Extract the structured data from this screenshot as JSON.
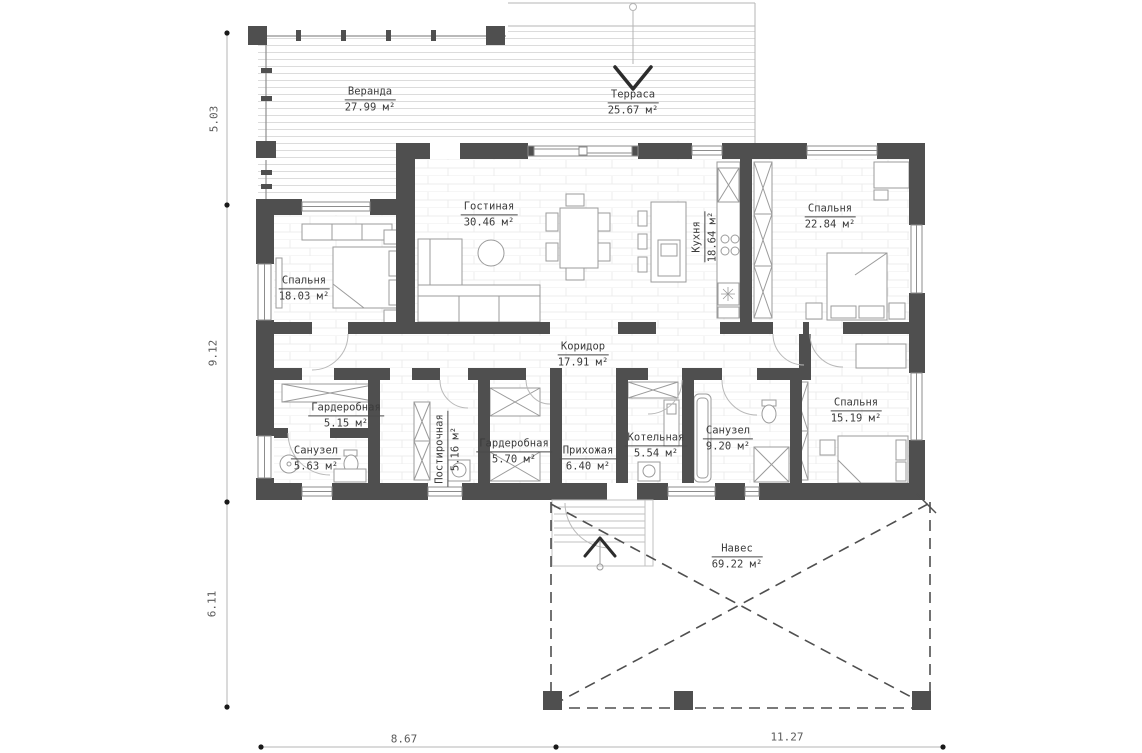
{
  "plan": {
    "rooms": {
      "veranda": {
        "name": "Веранда",
        "area": "27.99 м²"
      },
      "terrace": {
        "name": "Терраса",
        "area": "25.67 м²"
      },
      "living": {
        "name": "Гостиная",
        "area": "30.46 м²"
      },
      "kitchen": {
        "name": "Кухня",
        "area": "18.64 м²"
      },
      "bedroom1": {
        "name": "Спальня",
        "area": "18.03 м²"
      },
      "bedroom2": {
        "name": "Спальня",
        "area": "22.84 м²"
      },
      "bedroom3": {
        "name": "Спальня",
        "area": "15.19 м²"
      },
      "corridor": {
        "name": "Коридор",
        "area": "17.91 м²"
      },
      "wardrobe1": {
        "name": "Гардеробная",
        "area": "5.15 м²"
      },
      "wardrobe2": {
        "name": "Гардеробная",
        "area": "5.70 м²"
      },
      "laundry": {
        "name": "Постирочная",
        "area": "5.16 м²"
      },
      "bath1": {
        "name": "Санузел",
        "area": "5.63 м²"
      },
      "bath2": {
        "name": "Санузел",
        "area": "9.20 м²"
      },
      "boiler": {
        "name": "Котельная",
        "area": "5.54 м²"
      },
      "hallway": {
        "name": "Прихожая",
        "area": "6.40 м²"
      },
      "canopy": {
        "name": "Навес",
        "area": "69.22 м²"
      }
    },
    "dimensions": {
      "left": [
        "5.03",
        "9.12",
        "6.11"
      ],
      "bottom": [
        "8.67",
        "11.27"
      ]
    },
    "colors": {
      "wall": "#4f4f4f",
      "furniture_line": "#9b9b9b",
      "text": "#3b3b3b"
    }
  }
}
